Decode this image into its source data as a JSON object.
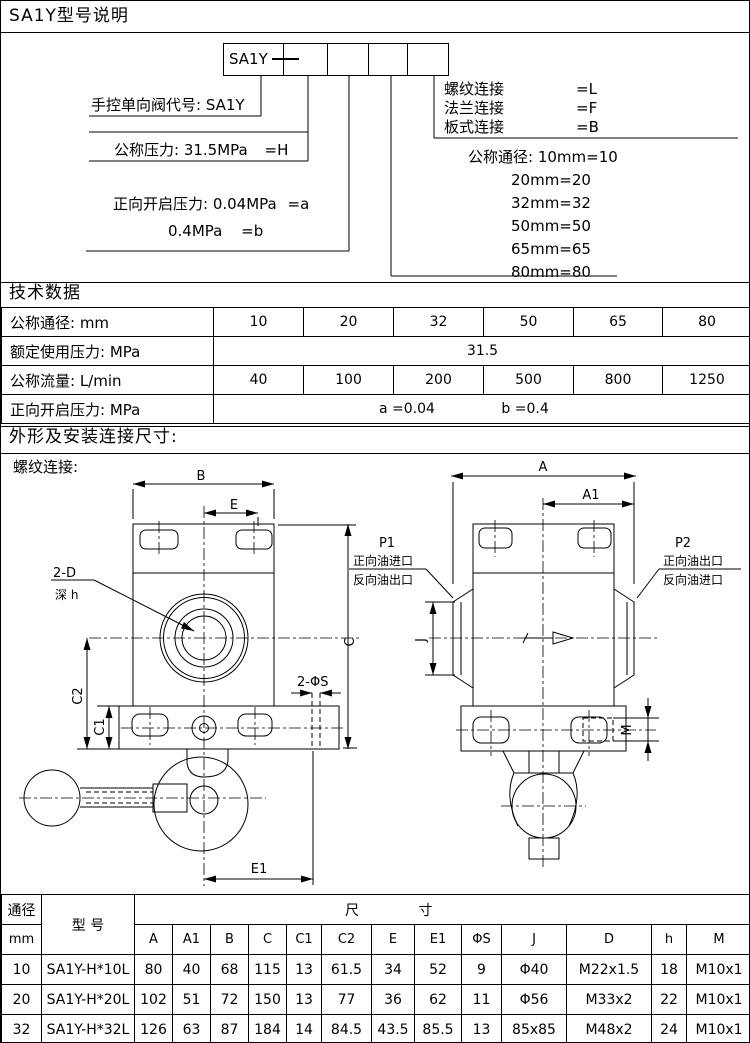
{
  "header": {
    "title": "SA1Y型号说明"
  },
  "model_diagram": {
    "code_prefix": "SA1Y",
    "designation": "手控单向阀代号: SA1Y",
    "pressure_label": "公称压力: 31.5MPa",
    "pressure_code": "=H",
    "opening1_label": "正向开启压力: 0.04MPa",
    "opening1_code": "=a",
    "opening2_label": "0.4MPa",
    "opening2_code": "=b",
    "connections": [
      {
        "label": "螺纹连接",
        "code": "=L"
      },
      {
        "label": "法兰连接",
        "code": "=F"
      },
      {
        "label": "板式连接",
        "code": "=B"
      }
    ],
    "diameter_first": "公称通径: 10mm=10",
    "diameter_rest": [
      "20mm=20",
      "32mm=32",
      "50mm=50",
      "65mm=65",
      "80mm=80"
    ]
  },
  "tech_section": {
    "title": "技术数据",
    "r1_label": "公称通径: mm",
    "r1": [
      "10",
      "20",
      "32",
      "50",
      "65",
      "80"
    ],
    "r2_label": "额定使用压力: MPa",
    "r2": "31.5",
    "r3_label": "公称流量: L/min",
    "r3": [
      "40",
      "100",
      "200",
      "500",
      "800",
      "1250"
    ],
    "r4_label": "正向开启压力: MPa",
    "r4a": "a =0.04",
    "r4b": "b =0.4"
  },
  "dims_section": {
    "title": "外形及安装连接尺寸:",
    "subtitle": "螺纹连接:",
    "labels": {
      "B": "B",
      "E": "E",
      "C": "C",
      "C1": "C1",
      "C2": "C2",
      "E1": "E1",
      "A": "A",
      "A1": "A1",
      "J": "J",
      "M": "M",
      "holes": "2-D",
      "depth": "深 h",
      "s_holes": "2-ΦS",
      "P1": "P1",
      "p1_line1": "正向油进口",
      "p1_line2": "反向油出口",
      "P2": "P2",
      "p2_line1": "正向油出口",
      "p2_line2": "反向油进口"
    }
  },
  "dim_table": {
    "h_dn": "通径",
    "h_dn_unit": "mm",
    "h_model": "型 号",
    "h_size_l": "尺",
    "h_size_r": "寸",
    "cols": [
      "A",
      "A1",
      "B",
      "C",
      "C1",
      "C2",
      "E",
      "E1",
      "ΦS",
      "J",
      "D",
      "h",
      "M"
    ],
    "rows": [
      {
        "dn": "10",
        "model": "SA1Y-H*10L",
        "v": [
          "80",
          "40",
          "68",
          "115",
          "13",
          "61.5",
          "34",
          "52",
          "9",
          "Φ40",
          "M22x1.5",
          "18",
          "M10x1"
        ]
      },
      {
        "dn": "20",
        "model": "SA1Y-H*20L",
        "v": [
          "102",
          "51",
          "72",
          "150",
          "13",
          "77",
          "36",
          "62",
          "11",
          "Φ56",
          "M33x2",
          "22",
          "M10x1"
        ]
      },
      {
        "dn": "32",
        "model": "SA1Y-H*32L",
        "v": [
          "126",
          "63",
          "87",
          "184",
          "14",
          "84.5",
          "43.5",
          "85.5",
          "13",
          "85x85",
          "M48x2",
          "24",
          "M10x1"
        ]
      }
    ]
  }
}
